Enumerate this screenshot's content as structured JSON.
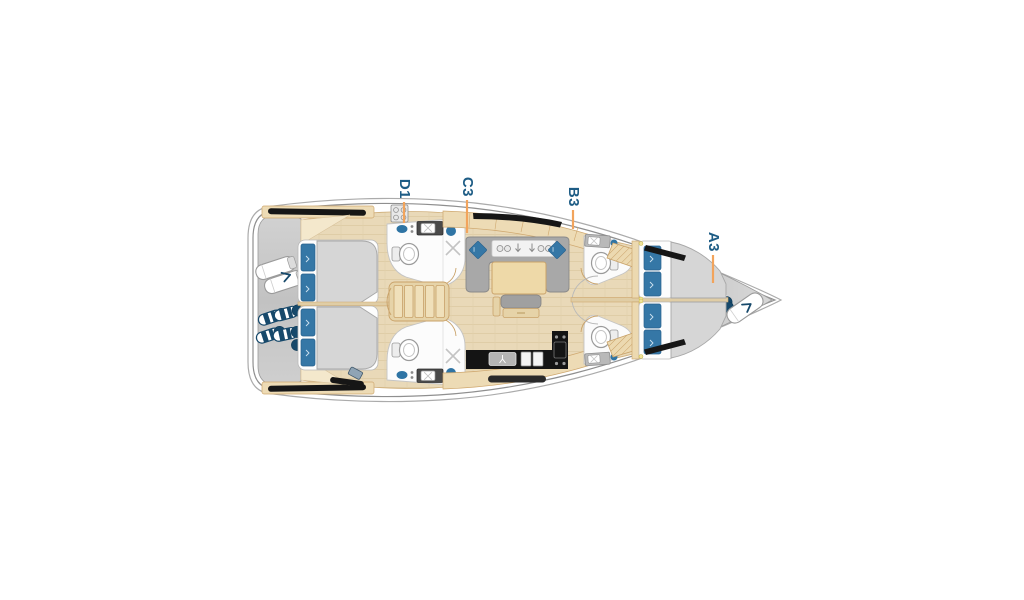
{
  "diagram": {
    "name": "sailing-yacht-deck-plan",
    "orientation": "bow-right-top-down",
    "cabins": [
      {
        "id": "D1"
      },
      {
        "id": "C3"
      },
      {
        "id": "B3"
      },
      {
        "id": "A3"
      }
    ],
    "colors": {
      "label_text": "#1D5C85",
      "leader_line": "#F2A45C",
      "hull_outline": "#9A9A9A",
      "deck_gray": "#C6C6C6",
      "floor_wood": "#E9D9B8",
      "cabinet_wood": "#EDDBB5",
      "wood_trim": "#C9A269",
      "upholstery_gray": "#A8A8A8",
      "mattress_gray": "#D6D6D6",
      "cushion_blue": "#3577A6",
      "fender_navy": "#17496B",
      "window_black": "#161616",
      "galley_counter_black": "#141414"
    },
    "icons": [
      "stern-fender-cluster",
      "stern-life-raft",
      "bow-fender-cluster",
      "bow-sail-bag",
      "toilet",
      "sink",
      "shower",
      "stove-burners",
      "companionway-steps"
    ]
  }
}
